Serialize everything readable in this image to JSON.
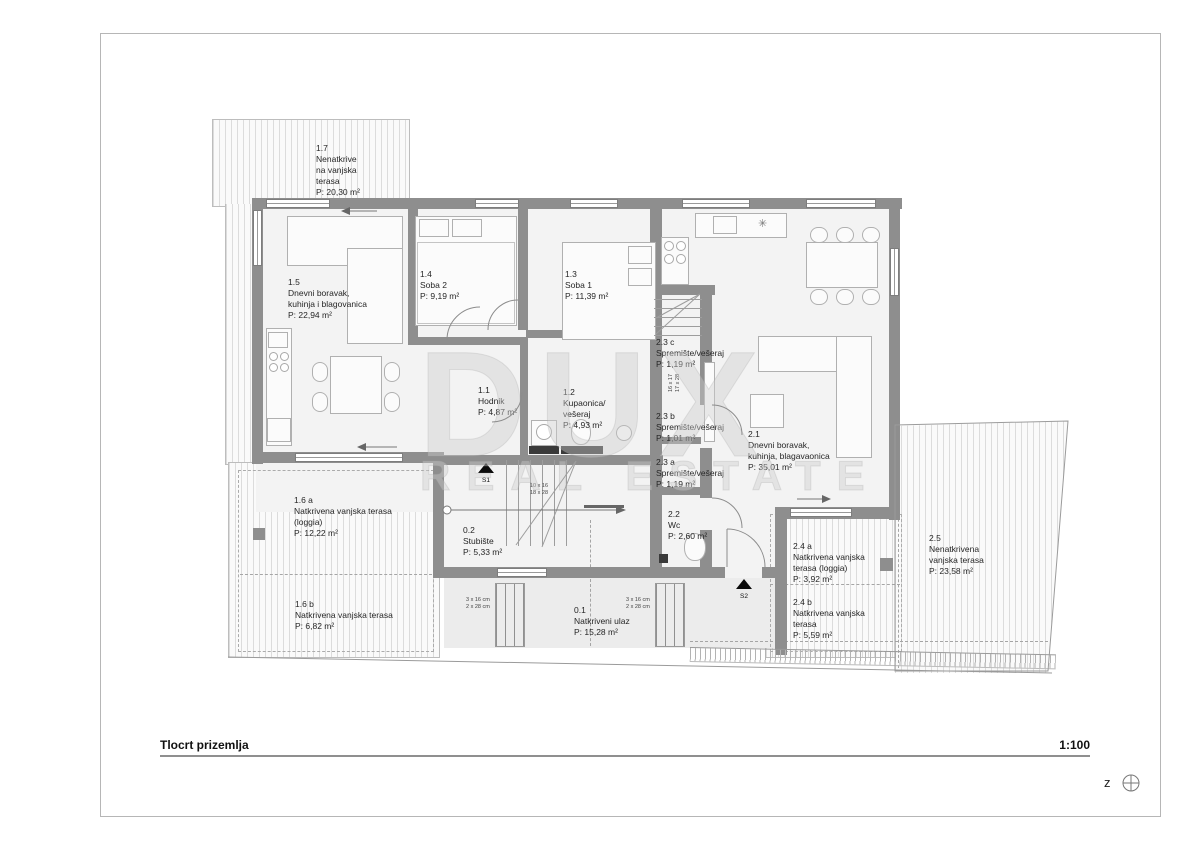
{
  "title_block": {
    "title": "Tlocrt prizemlja",
    "scale": "1:100",
    "compass_letter": "z"
  },
  "watermark": {
    "line1": "DUX",
    "line2": "REAL ESTATE"
  },
  "icons": {
    "extractor_fan": "✳"
  },
  "markers": [
    {
      "label": "S1"
    },
    {
      "label": "S2"
    }
  ],
  "stair_dimensions": {
    "storage_stair": "16 x 17\n17 x 28",
    "main_stair": "10 x 16\n18 x 28",
    "entry_steps_left": "3 x 16 cm\n2 x 28 cm",
    "entry_steps_right": "3 x 16 cm\n2 x 28 cm"
  },
  "rooms": [
    {
      "id": "1.7",
      "name": "Nenatkrive\nna vanjska\nterasa",
      "area": "P: 20,30 m²"
    },
    {
      "id": "1.5",
      "name": "Dnevni boravak,\nkuhinja i blagovanica",
      "area": "P: 22,94 m²"
    },
    {
      "id": "1.4",
      "name": "Soba 2",
      "area": "P: 9,19 m²"
    },
    {
      "id": "1.3",
      "name": "Soba 1",
      "area": "P: 11,39 m²"
    },
    {
      "id": "1.1",
      "name": "Hodnik",
      "area": "P: 4,87 m²"
    },
    {
      "id": "1.2",
      "name": "Kupaonica/\nvešeraj",
      "area": "P: 4,93 m²"
    },
    {
      "id": "2.3 c",
      "name": "Spremište/vešeraj",
      "area": "P: 1,19 m²"
    },
    {
      "id": "2.3 b",
      "name": "Spremište/vešeraj",
      "area": "P: 1,01 m²"
    },
    {
      "id": "2.3 a",
      "name": "Spremište/vešeraj",
      "area": "P: 1,19 m²"
    },
    {
      "id": "2.2",
      "name": "Wc",
      "area": "P: 2,60 m²"
    },
    {
      "id": "2.1",
      "name": "Dnevni boravak,\nkuhinja, blagavaonica",
      "area": "P: 35,01 m²"
    },
    {
      "id": "0.2",
      "name": "Stubište",
      "area": "P: 5,33 m²"
    },
    {
      "id": "0.1",
      "name": "Natkriveni ulaz",
      "area": "P: 15,28 m²"
    },
    {
      "id": "1.6 a",
      "name": "Natkrivena vanjska terasa\n(loggia)",
      "area": "P: 12,22 m²"
    },
    {
      "id": "1.6 b",
      "name": "Natkrivena vanjska terasa",
      "area": "P: 6,82 m²"
    },
    {
      "id": "2.4 a",
      "name": "Natkrivena vanjska\nterasa (loggia)",
      "area": "P: 3,92 m²"
    },
    {
      "id": "2.4 b",
      "name": "Natkrivena vanjska\nterasa",
      "area": "P: 5,59 m²"
    },
    {
      "id": "2.5",
      "name": "Nenatkrivena\nvanjska terasa",
      "area": "P: 23,58 m²"
    }
  ]
}
